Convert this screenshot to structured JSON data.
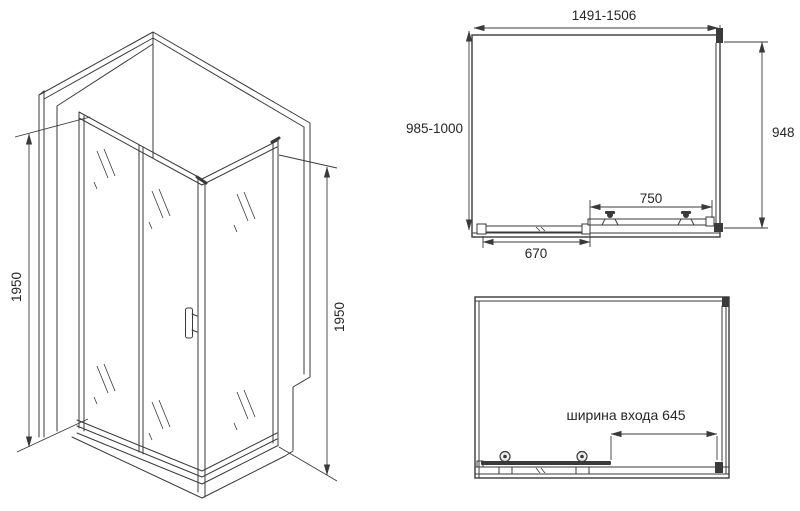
{
  "colors": {
    "line": "#3a3a3a",
    "text": "#262626",
    "bg": "#ffffff"
  },
  "iso_view": {
    "left_height": "1950",
    "right_height": "1950"
  },
  "plan_view": {
    "width_range": "1491-1506",
    "depth_range": "985-1000",
    "side_depth": "948",
    "door_width": "750",
    "fixed_panel_width": "670"
  },
  "front_view": {
    "entrance_width": "ширина входа 645"
  }
}
